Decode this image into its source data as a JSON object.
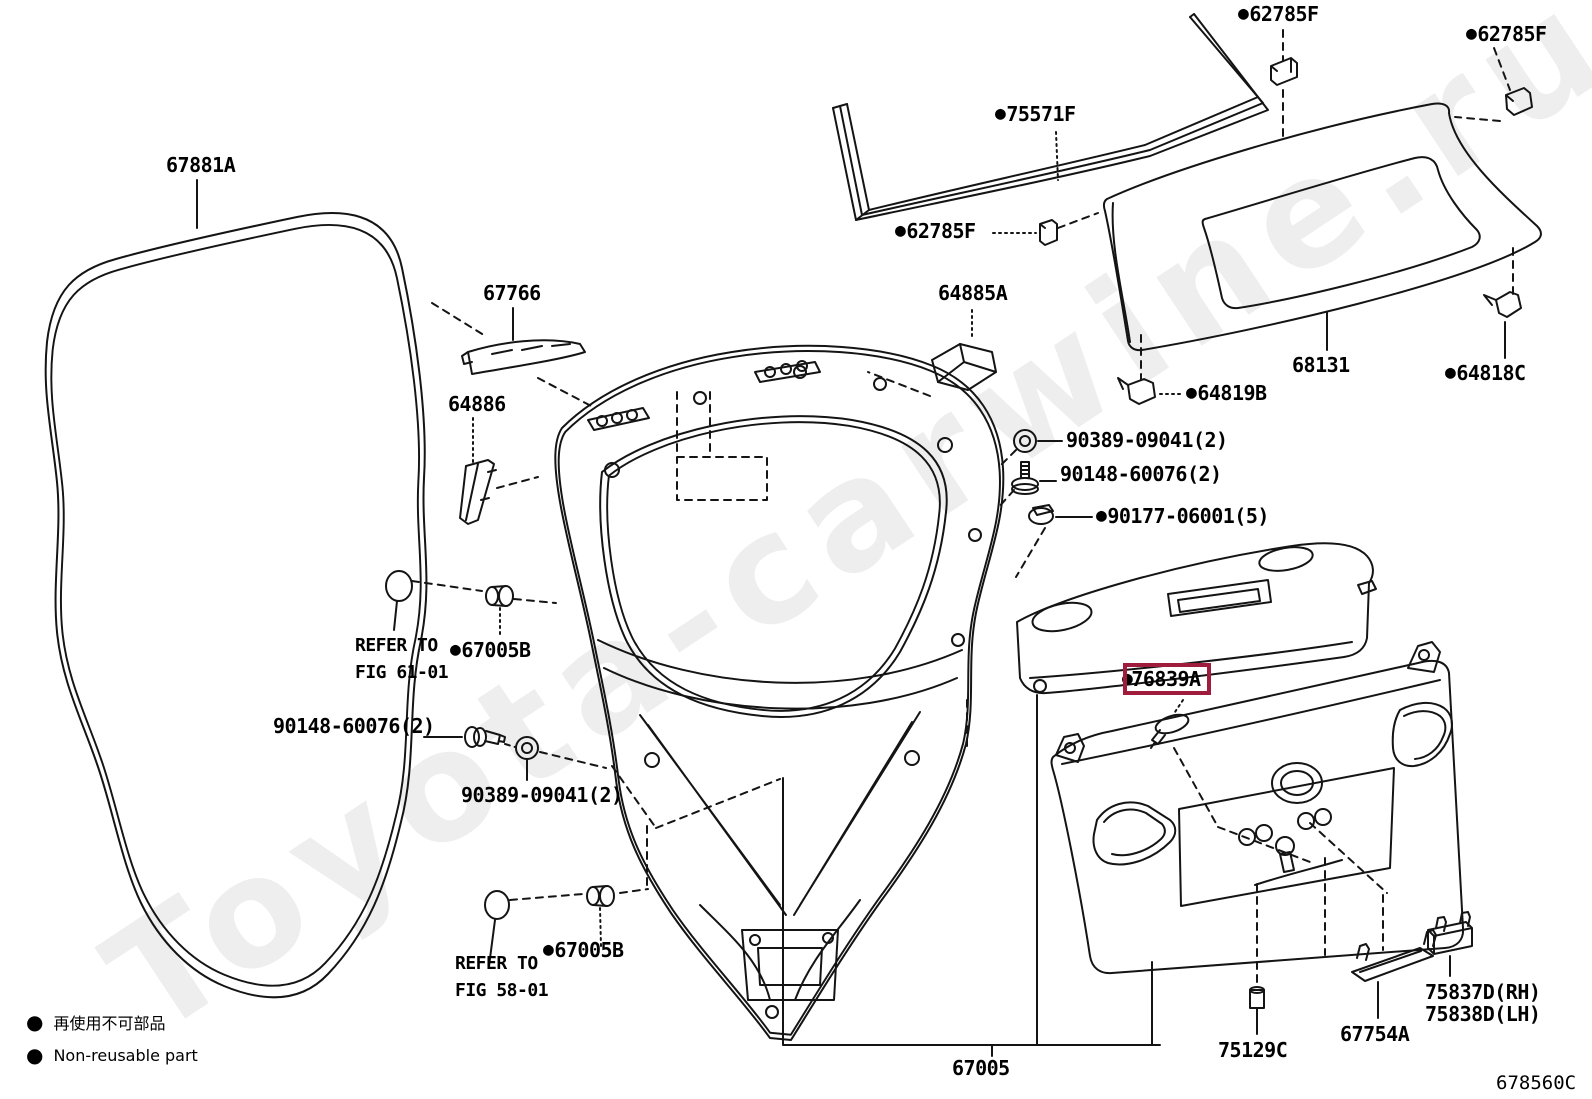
{
  "watermark": "Toyota-carwine.ru",
  "bullet_glyph": "●",
  "figure_code": "678560C",
  "highlight_color": "#A01C3C",
  "legend": {
    "jp": "再使用不可部品",
    "en": "Non-reusable part"
  },
  "refer_notes": [
    {
      "line1": "REFER TO",
      "line2": "FIG 61-01"
    },
    {
      "line1": "REFER TO",
      "line2": "FIG 58-01"
    }
  ],
  "labels": [
    {
      "part": "62785F",
      "bullet": true
    },
    {
      "part": "62785F",
      "bullet": true
    },
    {
      "part": "75571F",
      "bullet": true
    },
    {
      "part": "62785F",
      "bullet": true
    },
    {
      "part": "67881A",
      "bullet": false
    },
    {
      "part": "67766",
      "bullet": false
    },
    {
      "part": "64886",
      "bullet": false
    },
    {
      "part": "64885A",
      "bullet": false
    },
    {
      "part": "64819B",
      "bullet": true
    },
    {
      "part": "90389-09041(2)",
      "bullet": false
    },
    {
      "part": "90148-60076(2)",
      "bullet": false
    },
    {
      "part": "90177-06001(5)",
      "bullet": true
    },
    {
      "part": "67005B",
      "bullet": true
    },
    {
      "part": "90148-60076(2)",
      "bullet": false
    },
    {
      "part": "90389-09041(2)",
      "bullet": false
    },
    {
      "part": "67005B",
      "bullet": true
    },
    {
      "part": "76839A",
      "bullet": true,
      "highlighted": true
    },
    {
      "part": "68131",
      "bullet": false
    },
    {
      "part": "64818C",
      "bullet": true
    },
    {
      "part": "75837D(RH)",
      "bullet": false
    },
    {
      "part": "75838D(LH)",
      "bullet": false
    },
    {
      "part": "67754A",
      "bullet": false
    },
    {
      "part": "75129C",
      "bullet": false
    },
    {
      "part": "67005",
      "bullet": false
    }
  ]
}
